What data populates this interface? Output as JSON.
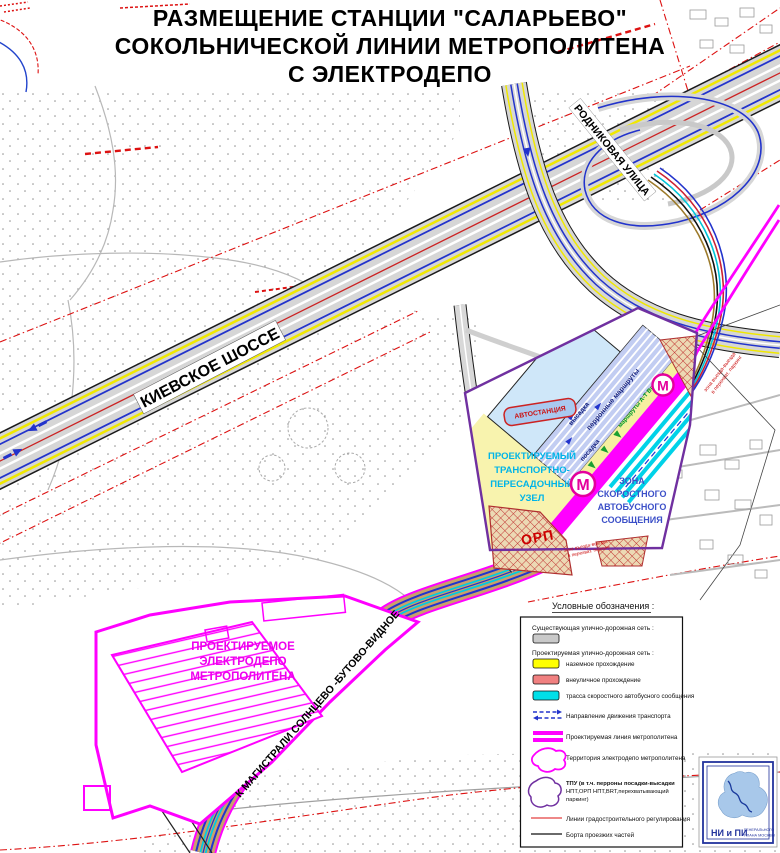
{
  "title": {
    "line1": "РАЗМЕЩЕНИЕ СТАНЦИИ \"САЛАРЬЕВО\"",
    "line2": "СОКОЛЬНИЧЕСКОЙ ЛИНИИ МЕТРОПОЛИТЕНА",
    "line3": "С ЭЛЕКТРОДЕПО"
  },
  "map": {
    "labels": {
      "kievskoe": "КИЕВСКОЕ ШОССЕ",
      "rodnikovaya": "РОДНИКОВАЯ УЛИЦА",
      "magistral": "К МАГИСТРАЛИ СОЛНЦЕВО -БУТОВО-ВИДНОЕ"
    },
    "depot": {
      "lines": [
        "ПРОЕКТИРУЕМОЕ",
        "ЭЛЕКТРОДЕПО",
        "МЕТРОПОЛИТЕНА"
      ]
    },
    "hub": {
      "tpu_label": [
        "ПРОЕКТИРУЕМЫЙ",
        "ТРАНСПОРТНО-",
        "ПЕРЕСАДОЧНЫЙ",
        "УЗЕЛ"
      ],
      "brt_zone": [
        "ЗОНА",
        "СКОРОСТНОГО",
        "АВТОБУСНОГО",
        "СООБЩЕНИЯ"
      ],
      "orp": "ОРП",
      "bus_station": "АВТОСТАНЦИЯ",
      "metro_m": "М",
      "platform": {
        "vysadka": "высадка",
        "perron": "перронные маршруты",
        "posadka": "посадка",
        "routes_green": "маршруты А-Т Внуково"
      },
      "entry_note": [
        "зона въезда-выезда",
        "в перехват. паркинг"
      ]
    }
  },
  "legend": {
    "title": "Условные обозначения :",
    "existing": "Существующая улично-дорожная сеть :",
    "projected": "Проектируемая улично-дорожная сеть :",
    "surface": "наземное прохождение",
    "offstreet": "внеуличное прохождение",
    "brt": "трасса скоростного автобусного сообщения",
    "direction": "Направление движения транспорта",
    "metro_line": "Проектируемая линия метрополитена",
    "depot_territory": "Территория электродепо метрополитена",
    "tpu": [
      "ТПУ (в т.ч. перроны посадки-высадки",
      "НПТ,ОРП НПТ,BRT,перехватывающий",
      "паркинг)"
    ],
    "reg_lines": "Линии градостроительного регулирования",
    "curbs": "Борта проезжих частей",
    "colors": {
      "existing_road": "#c9c9c9",
      "surface": "#ffff00",
      "offstreet": "#f08080",
      "brt": "#00dfe8",
      "metro": "#ff00ff",
      "tpu_boundary": "#7030a0",
      "reg_line": "#dd1111"
    }
  },
  "logo": {
    "abbr": "НИ и ПИ",
    "sub1": "ГЕНЕРАЛЬНОГО",
    "sub2": "ПЛАНА МОСКВЫ"
  }
}
